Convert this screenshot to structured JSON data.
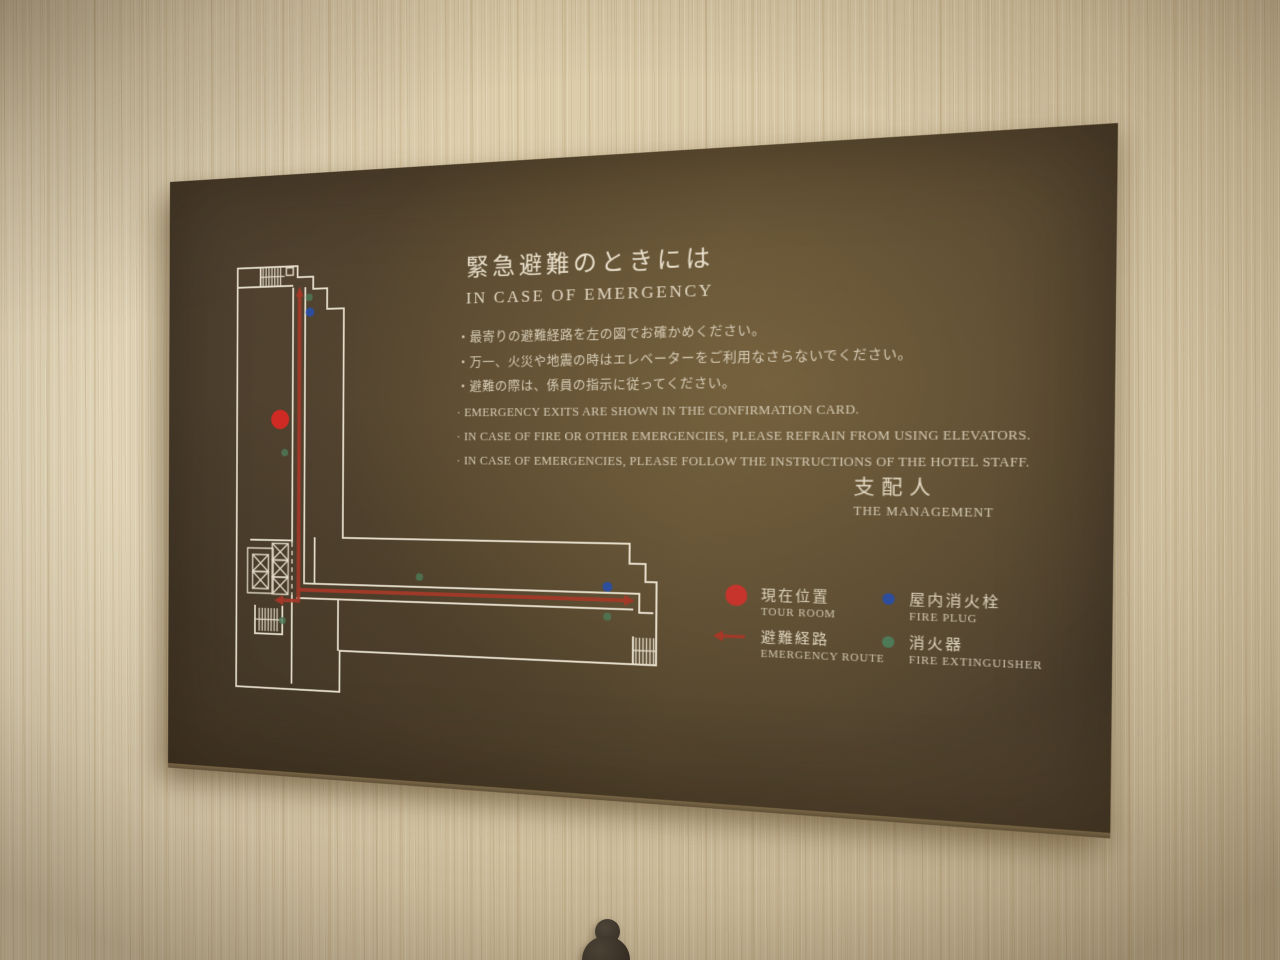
{
  "sign": {
    "title": {
      "jp": "緊急避難のときには",
      "en": "IN CASE OF EMERGENCY"
    },
    "instructions_jp": [
      "・最寄りの避難経路を左の図でお確かめください。",
      "・万一、火災や地震の時はエレベーターをご利用なさらないでください。",
      "・避難の際は、係員の指示に従ってください。"
    ],
    "instructions_en": [
      "· EMERGENCY EXITS ARE SHOWN IN THE CONFIRMATION CARD.",
      "· IN CASE OF FIRE OR OTHER EMERGENCIES, PLEASE REFRAIN FROM USING ELEVATORS.",
      "· IN CASE OF EMERGENCIES, PLEASE FOLLOW THE INSTRUCTIONS OF THE HOTEL STAFF."
    ],
    "signature": {
      "jp": "支配人",
      "en": "THE MANAGEMENT"
    },
    "legend": [
      {
        "marker": "current-position-dot",
        "color": "#c6342c",
        "jp": "現在位置",
        "en": "TOUR ROOM"
      },
      {
        "marker": "evacuation-route-arrow",
        "color": "#a63828",
        "jp": "避難経路",
        "en": "EMERGENCY ROUTE"
      },
      {
        "marker": "fire-plug-dot",
        "color": "#2d4d9d",
        "jp": "屋内消火栓",
        "en": "FIRE PLUG"
      },
      {
        "marker": "fire-extinguisher-dot",
        "color": "#4e7a58",
        "jp": "消火器",
        "en": "FIRE EXTINGUISHER"
      }
    ],
    "colors": {
      "plaque_brown": "#52432f",
      "text_cream": "#d9cfba",
      "plan_lines": "#ece4d2",
      "route_red": "#a63828",
      "wall_wood": "#d8c9aa"
    }
  }
}
